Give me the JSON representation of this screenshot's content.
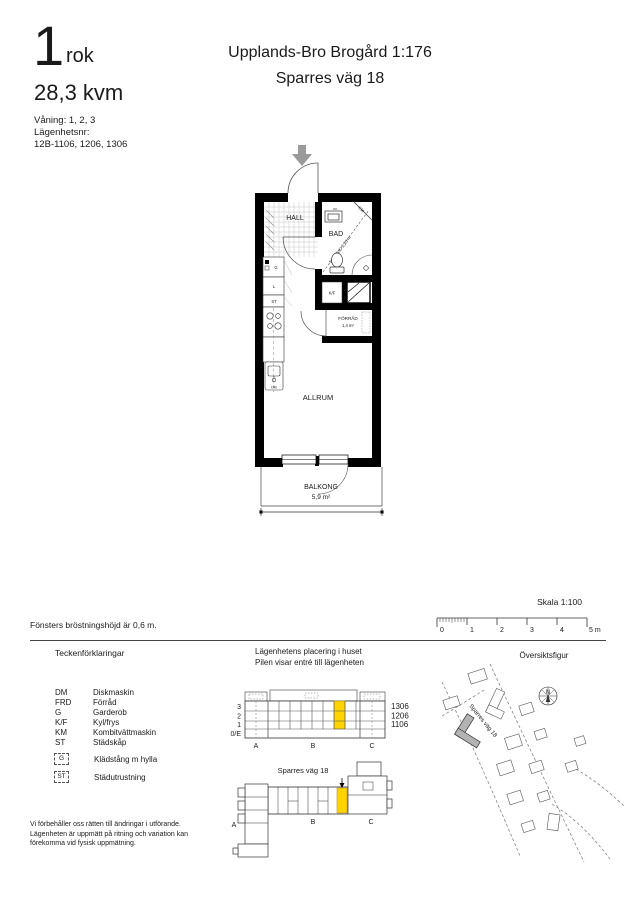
{
  "header": {
    "rooms_count": "1",
    "rooms_unit": "rok",
    "area": "28,3 kvm",
    "floors_line": "Våning: 1, 2, 3",
    "apartment_label": "Lägenhetsnr:",
    "apartment_numbers": "12B-1106, 1206, 1306",
    "project_title": "Upplands-Bro Brogård 1:176",
    "street": "Sparres väg 18"
  },
  "plan": {
    "hall": "HALL",
    "bathroom": "BAD",
    "bathroom_note": "TAKHÖJD 2,25 m",
    "washer": "KM",
    "fridge": "K/F",
    "storage": "FÖRRÅD",
    "storage_area": "1,4 m²",
    "living": "ALLRUM",
    "balcony": "BALKONG",
    "balcony_area": "5,9 m²",
    "closet_g": "G",
    "closet_l": "L",
    "closet_st": "ST",
    "dishwasher": "DM"
  },
  "scalebar": {
    "label": "Skala 1:100",
    "ticks": [
      "0",
      "1",
      "2",
      "3",
      "4"
    ],
    "end": "5 m"
  },
  "window_note": "Fönsters bröstningshöjd är 0,6 m.",
  "legend": {
    "title": "Teckenförklaringar",
    "items": [
      {
        "abbr": "DM",
        "label": "Diskmaskin"
      },
      {
        "abbr": "FRD",
        "label": "Förråd"
      },
      {
        "abbr": "G",
        "label": "Garderob"
      },
      {
        "abbr": "K/F",
        "label": "Kyl/frys"
      },
      {
        "abbr": "KM",
        "label": "Kombitvättmaskin"
      },
      {
        "abbr": "ST",
        "label": "Städskåp"
      }
    ],
    "boxed": [
      {
        "abbr": "G",
        "label": "Klädstång m hylla"
      },
      {
        "abbr": "ST",
        "label": "Städutrustning"
      }
    ]
  },
  "placement": {
    "title1": "Lägenhetens placering i huset",
    "title2": "Pilen visar entré till lägenheten",
    "floors": [
      "3",
      "2",
      "1",
      "0/E"
    ],
    "apartments": [
      "1306",
      "1206",
      "1106"
    ],
    "sections": [
      "A",
      "B",
      "C"
    ],
    "street": "Sparres väg 18"
  },
  "overview": {
    "title": "Översiktsfigur",
    "street": "Sparres väg 18",
    "compass_n": "N"
  },
  "disclaimer": "Vi förbehåller oss rätten till ändringar i utförande.\nLägenheten är uppmätt på ritning och variation kan\nförekomma vid fysisk uppmätning.",
  "colors": {
    "highlight": "#ffd400",
    "wall": "#000000",
    "arrow_gray": "#9a9a9a",
    "site_fill": "#b3b3b3"
  }
}
